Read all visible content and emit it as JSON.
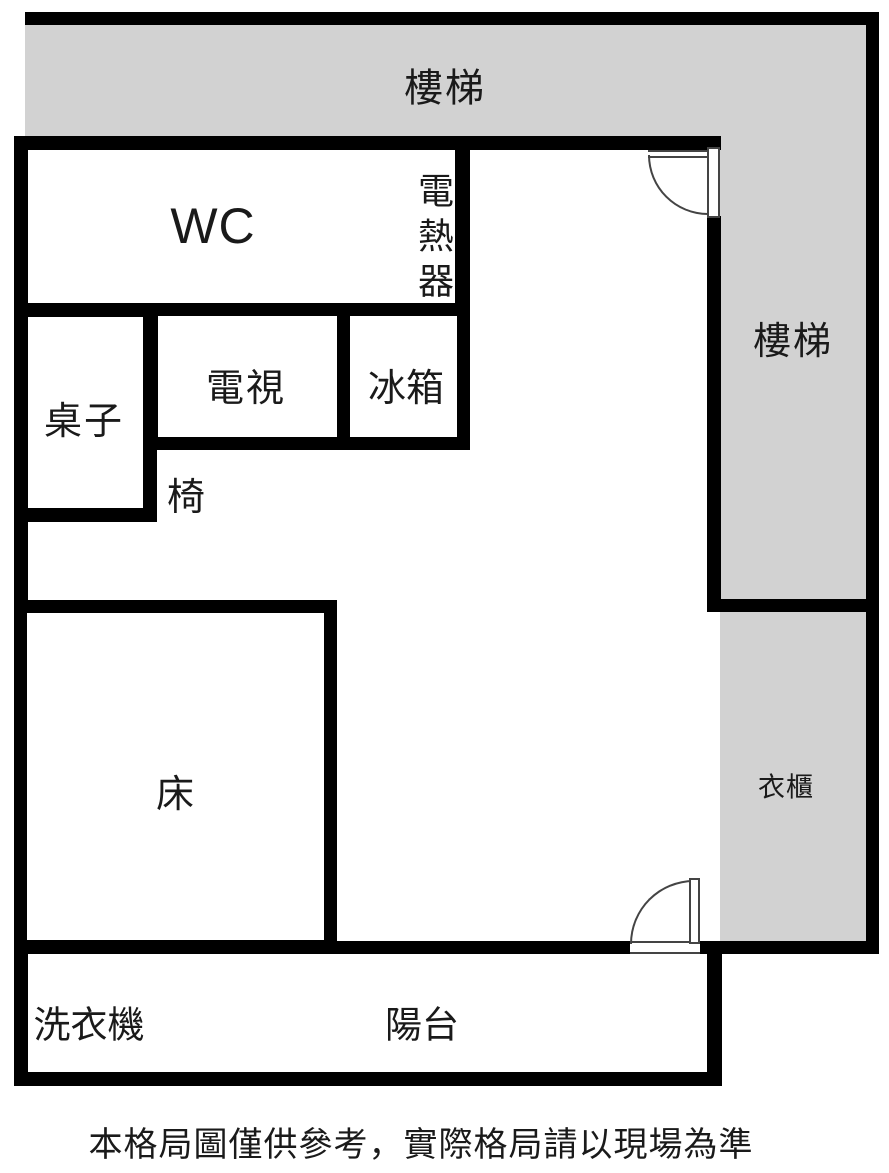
{
  "labels": {
    "stairs_top": "樓梯",
    "stairs_right": "樓梯",
    "wc": "WC",
    "water_heater": "電熱器",
    "table": "桌子",
    "tv": "電視",
    "fridge": "冰箱",
    "chair": "椅",
    "bed": "床",
    "wardrobe": "衣櫃",
    "washing_machine": "洗衣機",
    "balcony": "陽台"
  },
  "caption": "本格局圖僅供參考，實際格局請以現場為準",
  "colors": {
    "wall": "#000000",
    "stairs_fill": "#d2d2d2",
    "background": "#ffffff",
    "door_line": "#444444"
  }
}
